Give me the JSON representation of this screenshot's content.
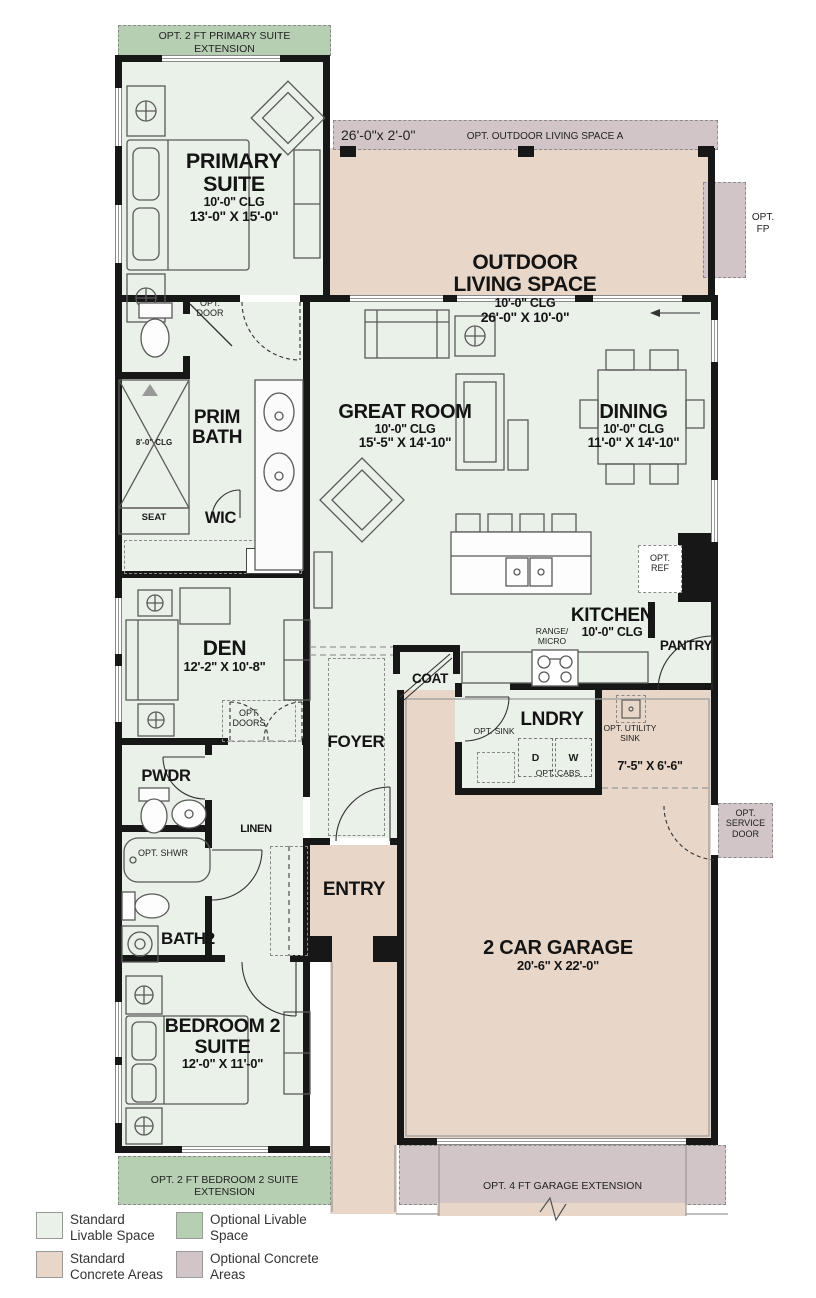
{
  "colors": {
    "wall": "#171717",
    "livable": "#eaf1e9",
    "optional-livable": "#b6cfb2",
    "concrete": "#e8d7c9",
    "optional-concrete": "#d2c5c8",
    "line": "#5a5a5a"
  },
  "banners": {
    "primary_suite_extension": "OPT. 2 FT PRIMARY SUITE EXTENSION",
    "outdoor_dim": "26'-0\"x 2'-0\"",
    "outdoor_label": "OPT. OUTDOOR LIVING SPACE A",
    "bedroom2_extension": "OPT. 2 FT BEDROOM 2 SUITE EXTENSION",
    "garage_extension": "OPT. 4 FT GARAGE EXTENSION"
  },
  "rooms": {
    "primary_suite": {
      "name": "PRIMARY SUITE",
      "ceiling": "10'-0\" CLG",
      "dims": "13'-0\" X 15'-0\""
    },
    "outdoor_living": {
      "name": "OUTDOOR LIVING SPACE",
      "ceiling": "10'-0\" CLG",
      "dims": "26'-0\" X 10'-0\""
    },
    "great_room": {
      "name": "GREAT ROOM",
      "ceiling": "10'-0\" CLG",
      "dims": "15'-5\" X 14'-10\""
    },
    "dining": {
      "name": "DINING",
      "ceiling": "10'-0\" CLG",
      "dims": "11'-0\" X 14'-10\""
    },
    "kitchen": {
      "name": "KITCHEN",
      "ceiling": "10'-0\" CLG"
    },
    "prim_bath": {
      "name": "PRIM BATH"
    },
    "wic": {
      "name": "WIC"
    },
    "den": {
      "name": "DEN",
      "dims": "12'-2\" X 10'-8\""
    },
    "pantry": {
      "name": "PANTRY"
    },
    "coat": {
      "name": "COAT"
    },
    "foyer": {
      "name": "FOYER"
    },
    "laundry": {
      "name": "LNDRY"
    },
    "utility": {
      "dims": "7'-5\" X 6'-6\""
    },
    "powder": {
      "name": "PWDR"
    },
    "linen": {
      "name": "LINEN"
    },
    "entry": {
      "name": "ENTRY"
    },
    "bath2": {
      "name": "BATH2"
    },
    "bedroom2": {
      "name": "BEDROOM 2 SUITE",
      "dims": "12'-0\" X 11'-0\""
    },
    "garage": {
      "name": "2 CAR GARAGE",
      "dims": "20'-6\" X 22'-0\""
    }
  },
  "annotations": {
    "opt_door": "OPT. DOOR",
    "opt_doors": "OPT. DOORS",
    "shower_ceiling": "8'-0\" CLG",
    "seat": "SEAT",
    "shelf": "SH",
    "dishwasher": "DW",
    "opt_ref": "OPT. REF",
    "range_micro": "RANGE/ MICRO",
    "opt_sink": "OPT. SINK",
    "dryer": "D",
    "washer": "W",
    "opt_cabs": "OPT. CABS",
    "opt_utility_sink": "OPT. UTILITY SINK",
    "opt_service_door": "OPT. SERVICE DOOR",
    "opt_shwr": "OPT. SHWR",
    "opt_fp": "OPT. FP"
  },
  "legend": {
    "items": [
      {
        "label": "Standard Livable Space",
        "color": "#eaf1e9"
      },
      {
        "label": "Optional Livable Space",
        "color": "#b6cfb2"
      },
      {
        "label": "Standard Concrete Areas",
        "color": "#e8d7c9"
      },
      {
        "label": "Optional Concrete Areas",
        "color": "#d2c5c8"
      }
    ]
  }
}
